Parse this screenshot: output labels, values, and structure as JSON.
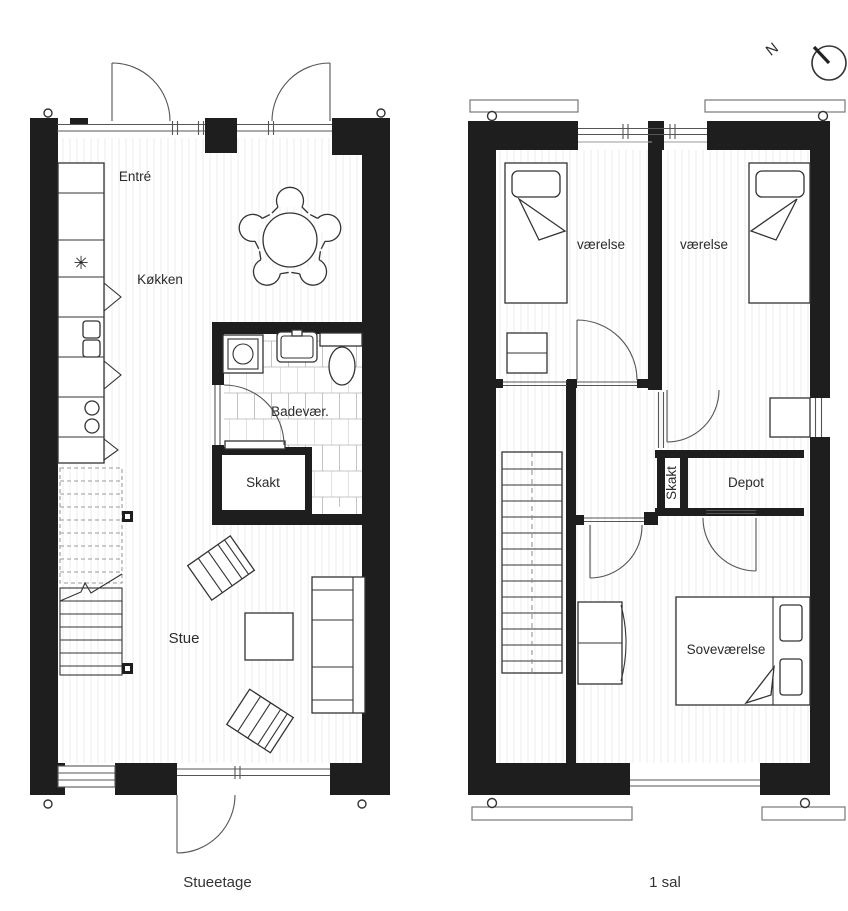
{
  "compass": {
    "label": "N"
  },
  "symbols": {
    "freezer": "✳"
  },
  "ground_floor": {
    "caption": "Stueetage",
    "labels": {
      "entre": "Entré",
      "kokken": "Køkken",
      "badevaer": "Badevær.",
      "skakt": "Skakt",
      "stue": "Stue"
    }
  },
  "first_floor": {
    "caption": "1 sal",
    "labels": {
      "vaerelse_left": "værelse",
      "vaerelse_right": "værelse",
      "skakt": "Skakt",
      "depot": "Depot",
      "sovevaerelse": "Soveværelse"
    }
  },
  "colors": {
    "wall": "#1e1e1e",
    "line": "#555555",
    "furniture_line": "#333333",
    "floor_stripe": "#ececec",
    "background": "#ffffff"
  }
}
